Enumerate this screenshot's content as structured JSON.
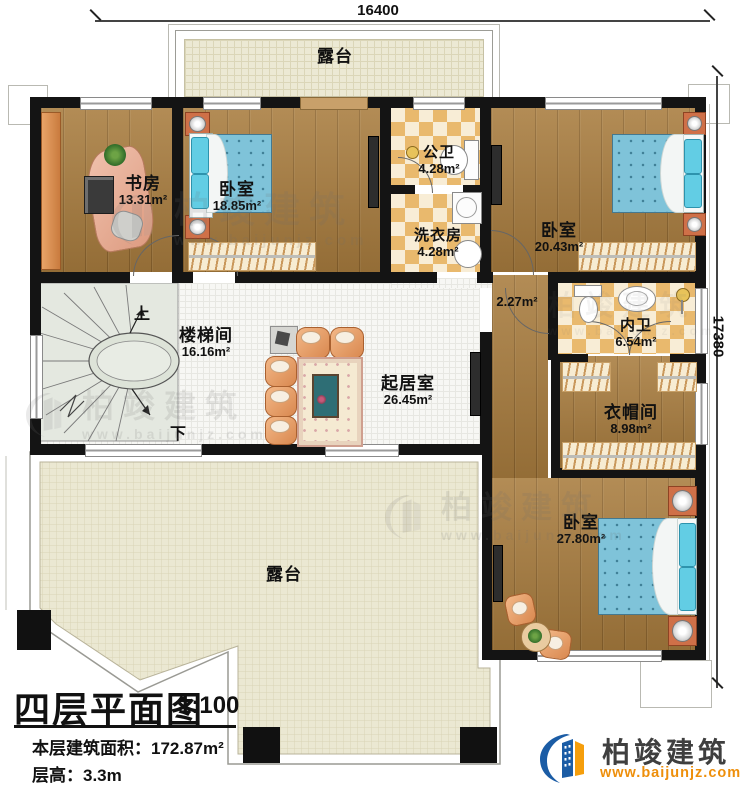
{
  "dimensions": {
    "top": "16400",
    "right": "17380"
  },
  "rooms": {
    "terrace_top": {
      "name": "露台"
    },
    "study": {
      "name": "书房",
      "area": "13.31m²"
    },
    "bedroom1": {
      "name": "卧室",
      "area": "18.85m²"
    },
    "public_bath": {
      "name": "公卫",
      "area": "4.28m²"
    },
    "laundry": {
      "name": "洗衣房",
      "area": "4.28m²"
    },
    "bedroom2": {
      "name": "卧室",
      "area": "20.43m²"
    },
    "stairwell": {
      "name": "楼梯间",
      "area": "16.16m²"
    },
    "hallway": {
      "area": "2.27m²"
    },
    "living": {
      "name": "起居室",
      "area": "26.45m²"
    },
    "master_bath": {
      "name": "内卫",
      "area": "6.54m²"
    },
    "cloakroom": {
      "name": "衣帽间",
      "area": "8.98m²"
    },
    "bedroom3": {
      "name": "卧室",
      "area": "27.80m²"
    },
    "terrace_bottom": {
      "name": "露台"
    }
  },
  "stairs": {
    "up": "上",
    "down": "下"
  },
  "title_block": {
    "title": "四层平面图",
    "scale": "1:100",
    "area_line": "本层建筑面积：172.87m²",
    "height_line": "层高：3.3m"
  },
  "brand": {
    "name": "柏竣建筑",
    "website": "www.baijunjz.com"
  },
  "watermark": {
    "name": "柏竣建筑",
    "website": "www.baijunjz.com"
  },
  "colors": {
    "brand_blue": "#1b5ca5",
    "brand_orange": "#f59e0c",
    "wall": "#141414"
  }
}
